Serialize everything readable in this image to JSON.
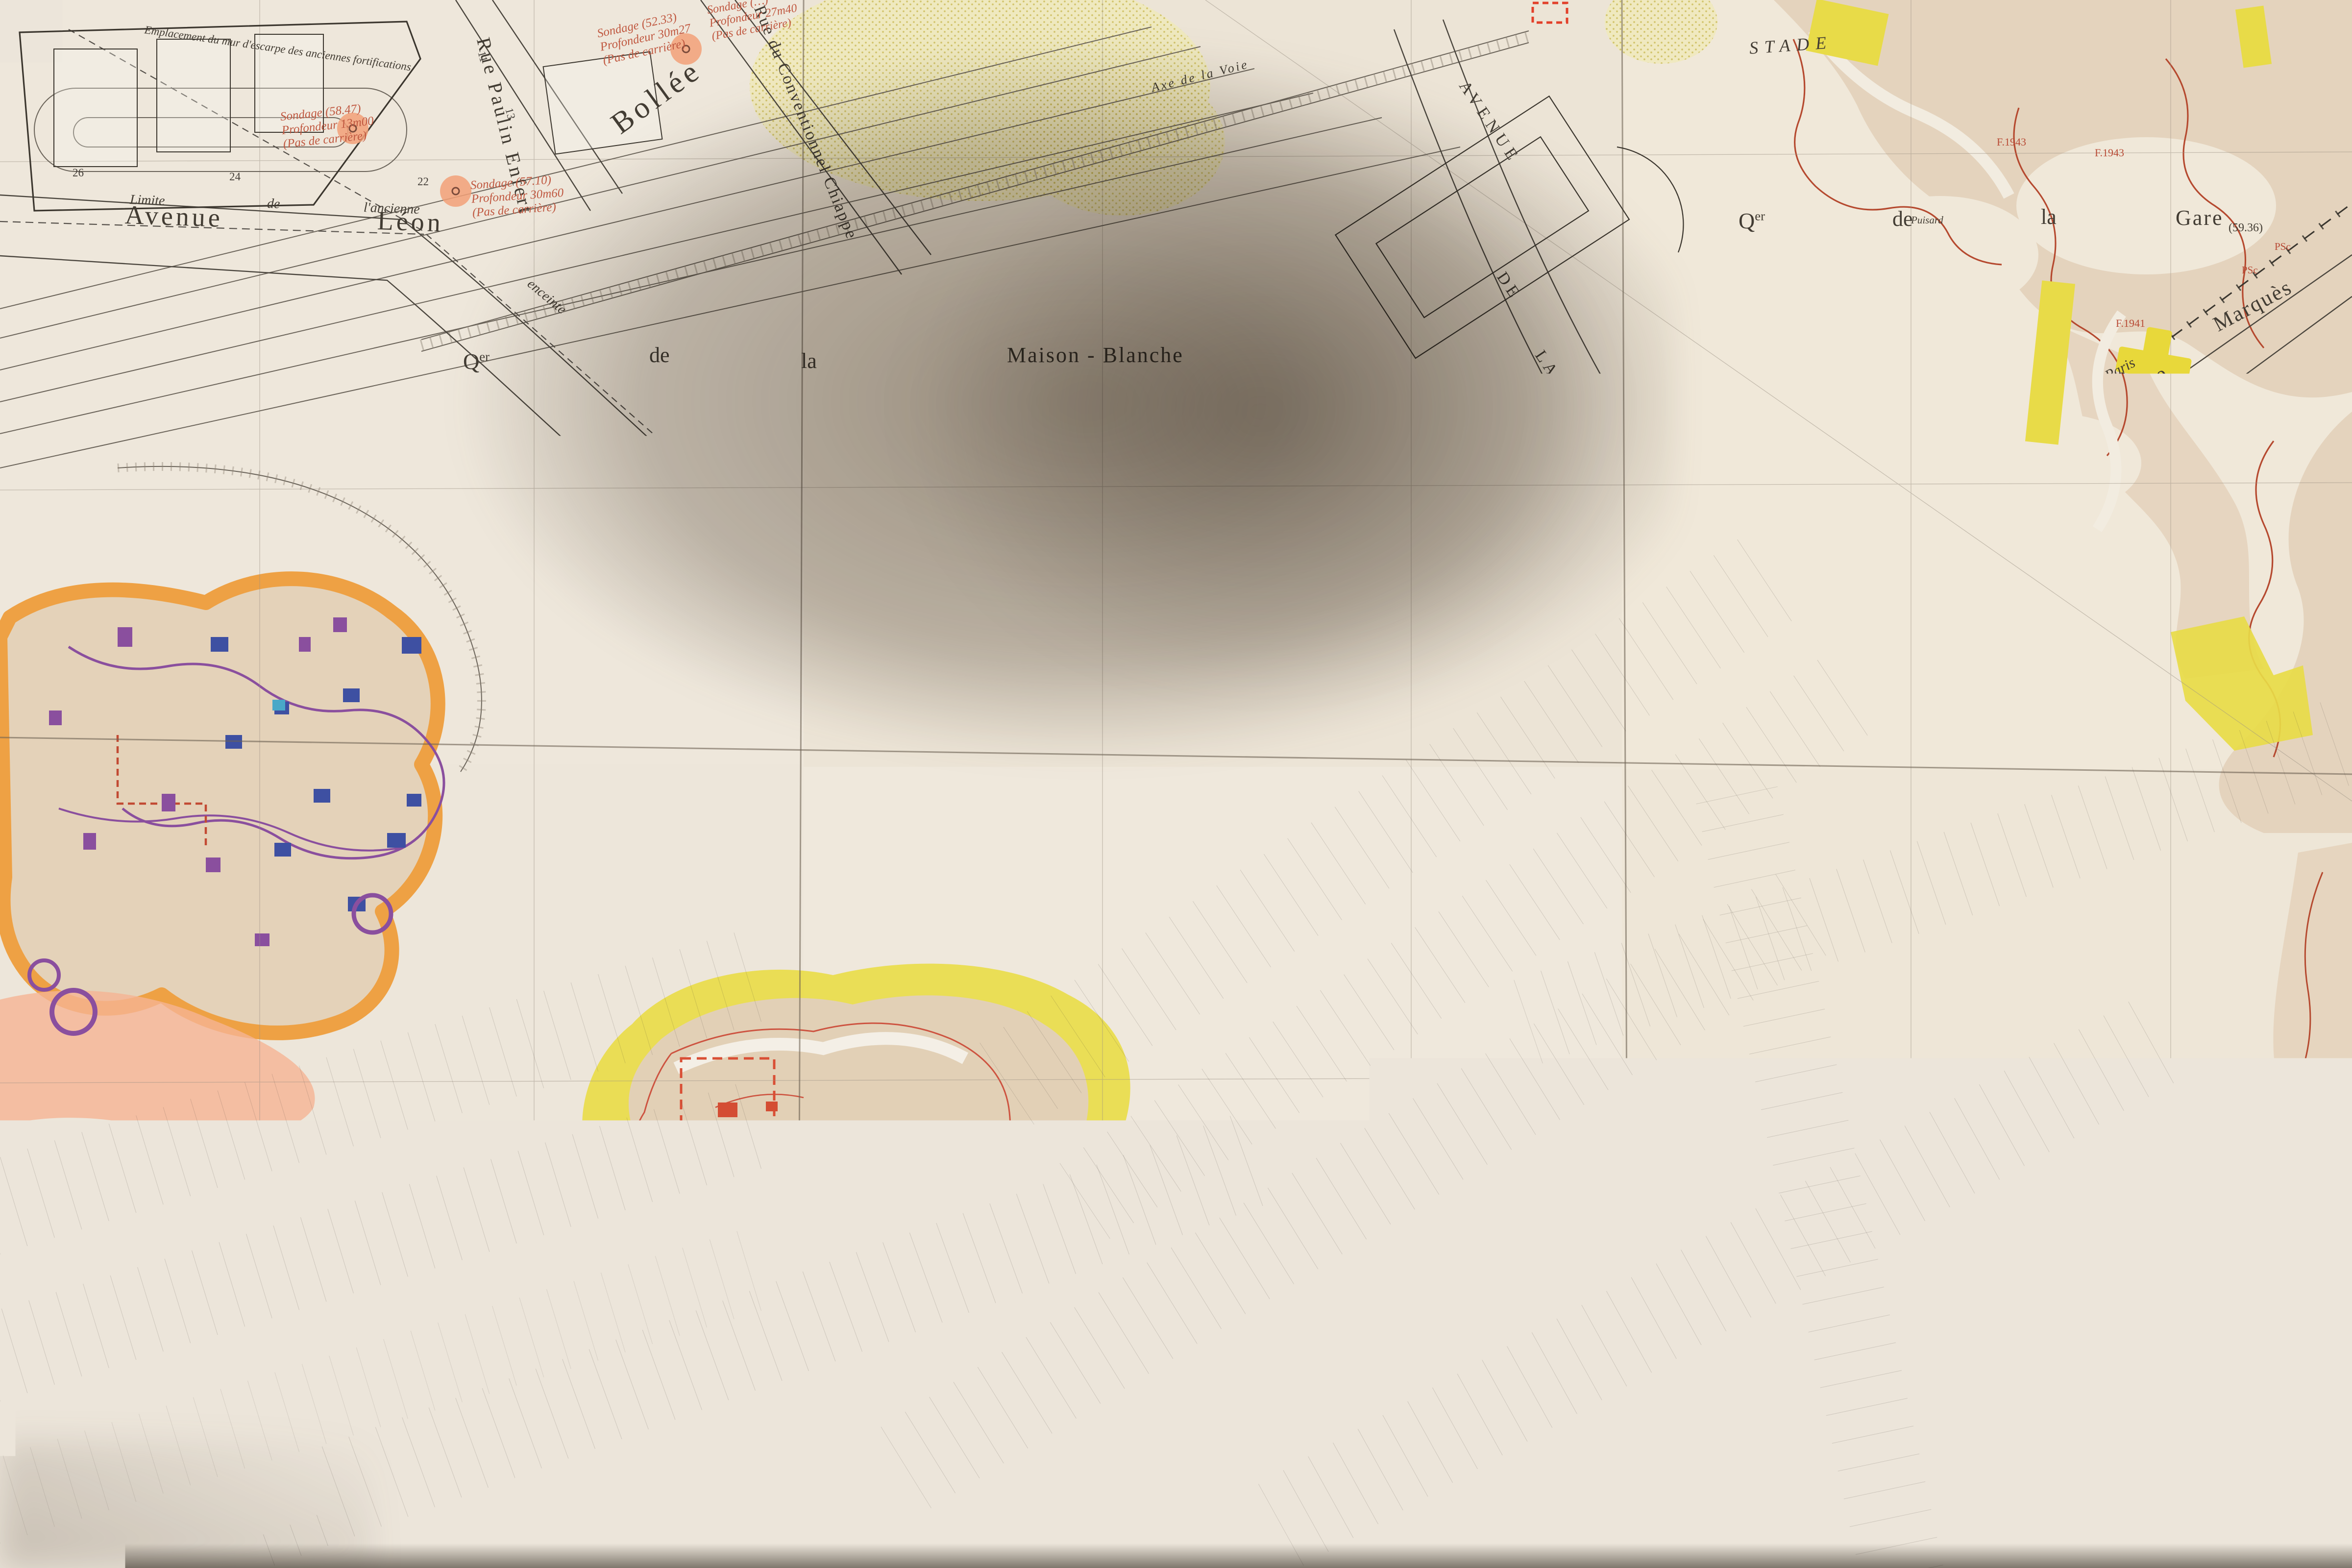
{
  "map": {
    "margin_number": "2400",
    "colors": {
      "paper": "#ece5da",
      "ink": "#423c33",
      "red_note": "#b84a35",
      "quarry_orange": "#ef9f3e",
      "quarry_tan": "#e4d3bd",
      "hazard_yellow": "#e8db48",
      "gallery_red": "#b5492f",
      "gallery_purple": "#8a4f9e",
      "pillar_blue": "#3e50a2",
      "sondage_dot": "#f2a078",
      "road_red": "#e2402a"
    },
    "districts": {
      "commune": "COMMUNE",
      "du": "DU",
      "kremlin": "KREMLIN",
      "bicetre": "BICÊTRE",
      "divry_sur": "D'IVRY  -  SUR",
      "seine": "SEINE",
      "q": "Q",
      "q_sup": "er",
      "maison_blanche": "Maison - Blanche",
      "gare": "Gare",
      "stade": "STADE"
    },
    "streets": {
      "avenue": "Avenue",
      "leon": "Léon",
      "bollee": "Bollée",
      "paulin": "Rue Paulin Enfert",
      "chiappe": "Rue du Conventionnel Chiappe",
      "avenue_u": "AVENUE",
      "de_u": "DE",
      "la_u": "LA",
      "porte_u": "PORTE",
      "choisy_u": "CHOISY",
      "boulevard": "Boulevard",
      "hippolyte": "Hippolyte",
      "marques": "Marquès",
      "leroy": "Leroy",
      "charles": "Charles",
      "berteaux": "Berteaux",
      "albert_meunier": "Rue Albert Meunier",
      "louis_marchal": "Rue Louis Marchal",
      "maurice": "Maurice",
      "chateaudun": "Châteaudun",
      "pasteur": "Pasteur",
      "voltaire": "Voltaire",
      "chalets": "Rue des Châlets",
      "rue": "Rue",
      "de": "de",
      "la": "la",
      "emile": "Emile",
      "zola": "Zola",
      "roger_salengro": "Roger  Salengro",
      "cd50": "( C.D. 50 )",
      "rn305": "( R.N. 305 )",
      "barbes": "Barbès",
      "avenue_du": "Avenue du",
      "cim_parisien": "Cimetière Parisien",
      "axe_voie": "Axe  de  la  Voie"
    },
    "notes": {
      "emplacement_mur": "Emplacement du mur d'escarpe des anciennes fortifications",
      "limite": "Limite",
      "ancienne": "l'ancienne",
      "enceinte": "enceinte",
      "ville": "Ville",
      "paris": "Paris",
      "regie": "RÉGIE  AUTONOME",
      "des": "DES",
      "transports": "TRANSPORTS",
      "parisiens": "PARISIENS",
      "ateliers": "( ATELIERS )",
      "dispensaire": "DISPENSAIRE",
      "municipal": "MUNICIPAL",
      "cimetiere": "CIMETIÈRE  PARISIEN  D'IVRY",
      "emplacement_etage": "Emplacement et étage incertains",
      "trou": "Trou de …\nà échelons entre\nles 2 étages",
      "ps_echelons": "PS\nà échelons",
      "sondage": "Sondage",
      "et": "et",
      "puisard": "Puisard",
      "sn_a": "Sondage (52.33)\nProfondeur 30m27\n(Pas de carrière)",
      "sn_b": "Sondage (58.47)\nProfondeur 13m00\n(Pas de carrière)",
      "sn_c": "Sondage (57.10)\nProfondeur 30m60\n(Pas de carrière)",
      "sn_d": "Sondage (…)\nProfondeur 27m40\n(Pas de carrière)",
      "forage": "Forage (59.84)\nProfondeur 45m80\nCalc. grossier (58.44)\nArgile plastique (30.84)",
      "sn_ratp": "Sondage\nProfondeur 12m00",
      "sn_5955": "Sondage (59.55)\nProfondeur 16m35",
      "sn_5950": "Sondage (59.50)\nProfondeur 17m00",
      "sn_5942": "Sondage (59.42)\nProfondeur 16m20",
      "sn_13": "Sondage\nProfondeur 13m00\n(Pas de carrière)",
      "f1943": "F.1943",
      "f1941": "F.1941",
      "f1911": "F.1911"
    },
    "markers": {
      "ap": "AP",
      "apc": "APc",
      "psc": "PSc",
      "ps": "PS",
      "n5936": "(59.36)"
    },
    "benchmarks": {
      "b6049": "(60.49)\n+",
      "b6107": "(61.07)\n+",
      "b6084": "(60.84)\n+",
      "b6036": "(60.36)\n+",
      "b5977": "(59.77)\n+",
      "b5985": "(59.85)\n+",
      "b5912": "(59.12)\n+"
    },
    "numbers": [
      "26",
      "24",
      "22",
      "11",
      "13",
      "15",
      "13",
      "11",
      "9",
      "7",
      "5",
      "3",
      "31",
      "29",
      "27",
      "25",
      "23",
      "21",
      "18",
      "16",
      "14",
      "12",
      "10",
      "28",
      "26",
      "24",
      "22",
      "20",
      "9",
      "11",
      "13b",
      "15",
      "17",
      "19",
      "21",
      "23",
      "16",
      "12",
      "1",
      "3",
      "5",
      "7",
      "9",
      "4",
      "8",
      "16",
      "18",
      "2",
      "4",
      "6",
      "8",
      "33",
      "35",
      "37",
      "39",
      "63",
      "65",
      "67",
      "69",
      "72",
      "9",
      "13",
      "15"
    ]
  }
}
